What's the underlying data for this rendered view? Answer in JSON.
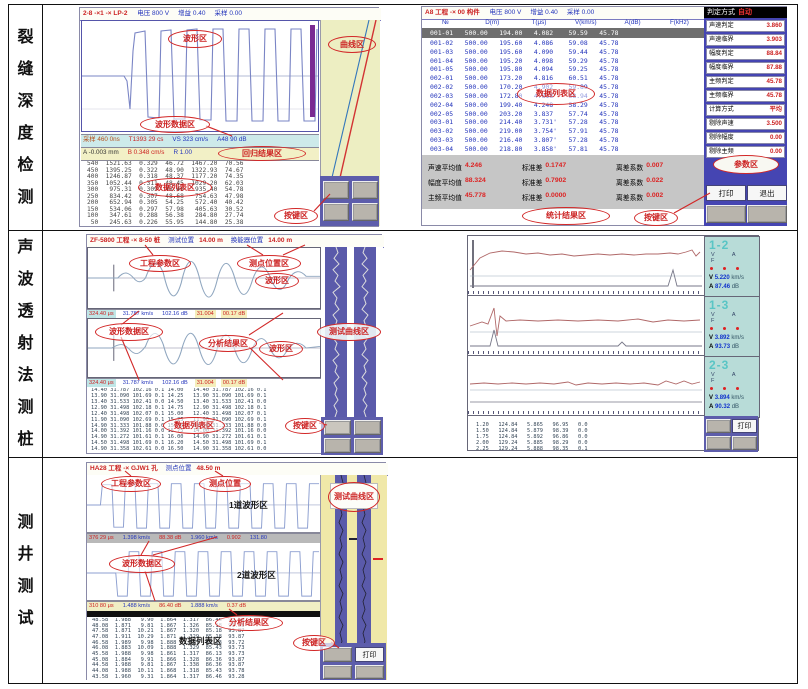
{
  "colors": {
    "annotation_red": "#d22828",
    "table_blue": "#2233bb",
    "value_red": "#cc2200",
    "sidebar_blue": "#4545b2",
    "panel_teal": "#b8dcd8",
    "curve_bg": "#edeec2",
    "status_cyan": "#cdeaea",
    "status_yellow": "#f2f0c6",
    "button_grey": "#b8b4ac",
    "button_panel_blue": "#5d5dab",
    "highlight_row": "#6e6e6e"
  },
  "rows": [
    {
      "label": "裂缝深度检测",
      "left": {
        "title": "2-8 -×1 -× LP-2",
        "title_vals": [
          "电压 800 V",
          "增益 0.40",
          "采样 0.00"
        ],
        "status1": [
          "采样 460 0ns",
          "T1393 29 cs",
          "VS 323 cm/s",
          "A48 90 dB"
        ],
        "status2": [
          "A -0.003 mm",
          "B 0.348 cm/s",
          "R 1.00"
        ],
        "datalist": [
          "540  1521.63  0.329  46.72  1467.20  70.56",
          "450  1395.25  0.322  48.90  1322.93  74.67",
          "400  1246.87  0.318  48.37  1177.20  74.35",
          "350  1052.44  0.311  48.45  1029.20  62.03",
          "300   975.31  0.309  48.46   935.40  54.78",
          "250   834.42  0.307  48.68   754.63  47.98",
          "200   652.94  0.305  54.25   572.40  40.42",
          "150   534.06  0.297  57.98   405.63  30.52",
          "100   347.61  0.288  56.38   284.80  27.74",
          " 50   245.63  0.226  55.95   144.80  25.38"
        ],
        "ann": {
          "wave": "波形区",
          "curve": "曲线区",
          "wavedata": "波形数据区",
          "regress": "回归结果区",
          "datalist": "数据列表区",
          "keys": "按键区"
        }
      },
      "right": {
        "title": "A8 工程 -× 00 构件",
        "title_vals": [
          "电压 800 V",
          "增益 0.40",
          "采样 0.00"
        ],
        "judge_label": "判定方式",
        "judge_value": "自动",
        "table_head": [
          "№",
          "D(m)",
          "T(μs)",
          "V(km/s)",
          "A(dB)",
          "F(kHz)"
        ],
        "table_hl": "001-01   500.00   194.00   4.082    59.59   45.78",
        "table_rows": [
          "001-02   500.00   195.60   4.086    59.08   45.78",
          "001-03   500.00   195.60   4.090    59.44   45.78",
          "001-04   500.00   195.20   4.098    59.29   45.78",
          "001-05   500.00   195.80   4.094    59.25   45.78",
          "002-01   500.00   173.20   4.816    60.51   45.78",
          "002-02   500.00   170.20   4.902    59.89   45.78",
          "002-03   500.00   172.80   4.818    58.94   45.78",
          "002-04   500.00   199.40   4.248    58.29   45.78",
          "002-05   500.00   203.20   3.837    57.74   45.78",
          "003-01   500.00   214.40   3.731'   57.28   45.78",
          "003-02   500.00   219.00   3.754'   57.91   45.78",
          "003-03   500.00   216.40   3.807'   57.28   45.78",
          "003-04   500.00   218.80   3.858'   57.81   45.78"
        ],
        "stats": [
          {
            "label": "声速平均值",
            "value": "4.246"
          },
          {
            "label": "标准差",
            "value": "0.1747"
          },
          {
            "label": "离差系数",
            "value": "0.007"
          },
          {
            "label": "幅度平均值",
            "value": "88.324"
          },
          {
            "label": "标准差",
            "value": "0.7902"
          },
          {
            "label": "离差系数",
            "value": "0.022"
          },
          {
            "label": "主频平均值",
            "value": "45.778"
          },
          {
            "label": "标准差",
            "value": "0.0000"
          },
          {
            "label": "离差系数",
            "value": "0.002"
          }
        ],
        "sidebar": [
          {
            "label": "声速判定",
            "value": "3.860"
          },
          {
            "label": "声速临界",
            "value": "3.903"
          },
          {
            "label": "幅度判定",
            "value": "88.84"
          },
          {
            "label": "幅度临界",
            "value": "87.88"
          },
          {
            "label": "主频判定",
            "value": "45.78"
          },
          {
            "label": "主频临界",
            "value": "45.78"
          },
          {
            "label": "计算方式",
            "value": "平均"
          },
          {
            "label": "剔除声速",
            "value": "3.500"
          },
          {
            "label": "剔除幅度",
            "value": "0.00"
          },
          {
            "label": "剔除主频",
            "value": "0.00"
          }
        ],
        "btn_print": "打印",
        "btn_exit": "退出",
        "ann": {
          "datalist": "数据列表区",
          "param": "参数区",
          "stats": "统计结果区",
          "keys": "按键区"
        }
      }
    },
    {
      "label": "声波透射法测桩",
      "left": {
        "title": "ZF-5800 工程 -× 8-50 桩",
        "pos1_label": "测试位置",
        "pos1": "14.00 m",
        "pos2_label": "换能器位置",
        "pos2": "14.00 m",
        "status1": [
          "324.40 μs",
          "31.787 km/s",
          "102.16 dB",
          "31.004",
          "00.17 dB"
        ],
        "status2": [
          "324.40 μs",
          "31.787 km/s",
          "102.16 dB",
          "31.004",
          "00.17 dB"
        ],
        "datalist": [
          "14.40 31.787 102.16 0.1 14.00   14.40 31.787 102.16 0.1",
          "13.90 31.090 101.69 0.1 14.25   13.90 31.090 101.69 0.1",
          "13.40 31.533 102.41 0.0 14.50   13.40 31.533 102.41 0.0",
          "12.90 31.498 102.18 0.1 14.75   12.90 31.498 102.18 0.1",
          "12.40 31.498 102.07 0.1 15.00   12.40 31.498 102.07 0.1",
          "11.90 31.090 102.69 0.1 15.25   11.90 31.090 102.69 0.1",
          "14.90 31.333 101.88 0.0 15.50   14.90 31.333 101.88 0.0",
          "14.00 31.392 101.16 0.0 15.75   14.00 31.392 101.16 0.0",
          "14.90 31.272 101.61 0.1 16.00   14.90 31.272 101.61 0.1",
          "14.50 31.498 101.69 0.1 16.20   14.50 31.498 101.69 0.1",
          "14.90 31.358 102.61 0.0 16.50   14.90 31.358 102.61 0.0"
        ],
        "ann": {
          "proj": "工程参数区",
          "point": "测点位置区",
          "wave": "波形区",
          "wavedata": "波形数据区",
          "result": "分析结果区",
          "curve": "测试曲线区",
          "datalist": "数据列表区",
          "keys": "按键区"
        }
      },
      "right": {
        "panels": [
          {
            "id": "1-2",
            "vaf": "V A F",
            "v_label": "V",
            "v": "5.220",
            "v_unit": "km/s",
            "a_label": "A",
            "a": "87.46",
            "a_unit": "dB"
          },
          {
            "id": "1-3",
            "vaf": "V A F",
            "v_label": "V",
            "v": "3.892",
            "v_unit": "km/s",
            "a_label": "A",
            "a": "93.73",
            "a_unit": "dB"
          },
          {
            "id": "2-3",
            "vaf": "V A F",
            "v_label": "V",
            "v": "3.894",
            "v_unit": "km/s",
            "a_label": "A",
            "a": "90.32",
            "a_unit": "dB"
          }
        ],
        "table_rows": [
          "1.20   124.84   5.865   96.95   0.0",
          "1.50   124.84   5.879   98.39   0.0",
          "1.75   124.84   5.892   96.86   0.0",
          "2.00   129.24   5.885   98.29   0.0",
          "2.25   129.24   5.888   98.35   0.1",
          "2.50   129.04   5.913   98.68   0.1"
        ],
        "btn_print": "打印"
      }
    },
    {
      "label": "测井测试",
      "screen": {
        "title": "HA28 工程 -× GJW1 孔",
        "pos_label": "测点位置",
        "pos": "48.50 m",
        "status1": [
          "376 29 μs",
          "1.398 km/s",
          "88.38 dB",
          "1.960 km/s",
          "0.902",
          "131.80"
        ],
        "status2": [
          "310 80 μs",
          "1.488 km/s",
          "86.40 dB",
          "1.888 km/s",
          "0.37 dB"
        ],
        "datalist": [
          "48.58  1.988   9.90  1.864  1.317  86.46  93.58",
          "48.08  1.871   9.81  1.867  1.326  85.18  93.58",
          "47.58  1.871  10.21  1.867  1.320  85.18  93.87",
          "47.08  1.911  10.29  1.871  1.329  85.18  93.87",
          "46.58  1.989   9.98  1.888  1.327  85.13  93.72",
          "46.08  1.883  10.09  1.888  1.329  85.43  93.73",
          "45.58  1.988   9.98  1.861  1.317  86.13  93.73",
          "45.08  1.884   9.91  1.866  1.328  86.36  93.87",
          "44.58  1.988   9.81  1.867  1.338  86.36  93.87",
          "44.08  1.988  10.11  1.868  1.318  85.43  93.78",
          "43.58  1.960   9.31  1.864  1.317  86.46  93.28"
        ],
        "ann": {
          "proj": "工程参数区",
          "point": "测点位置",
          "wave1": "1道波形区",
          "wavedata": "波形数据区",
          "wave2": "2道波形区",
          "result": "分析结果区",
          "datalist": "数据列表区",
          "keys": "按键区",
          "curve": "测试曲线区"
        },
        "btn_print": "打印"
      }
    }
  ]
}
